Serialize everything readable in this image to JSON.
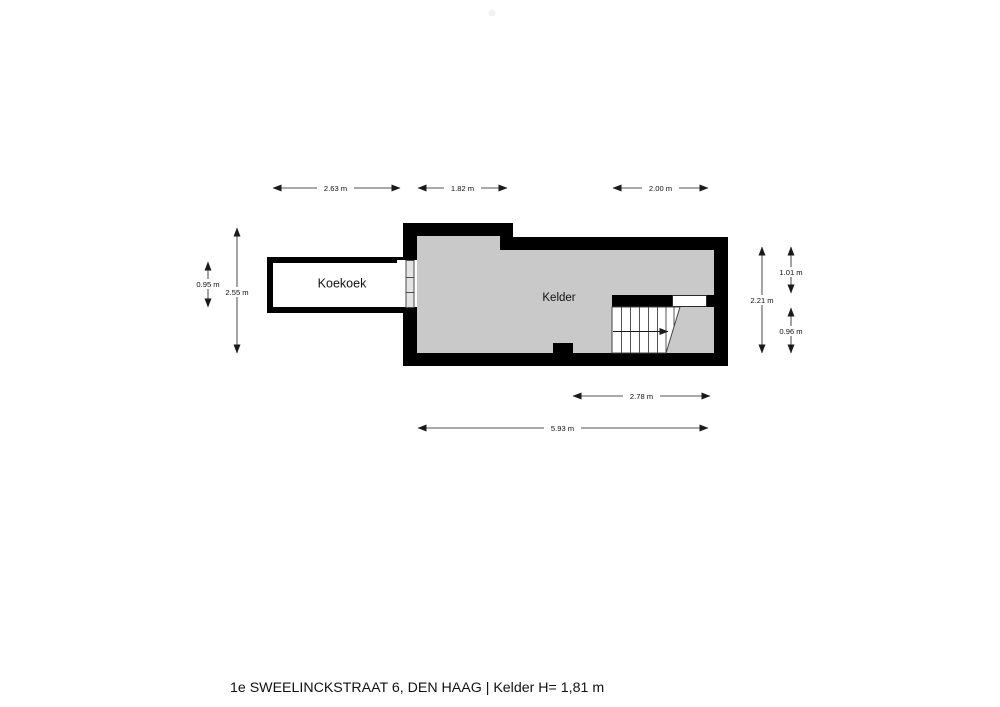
{
  "title": "1e SWEELINCKSTRAAT 6, DEN HAAG  | Kelder H= 1,81 m",
  "rooms": [
    {
      "name": "Koekoek"
    },
    {
      "name": "Kelder"
    }
  ],
  "dimensions": {
    "top": [
      {
        "label": "2.63 m"
      },
      {
        "label": "1.82 m"
      },
      {
        "label": "2.00 m"
      }
    ],
    "bottom": [
      {
        "label": "2.78 m"
      },
      {
        "label": "5.93 m"
      }
    ],
    "left": [
      {
        "label": "0.95 m"
      },
      {
        "label": "2.55 m"
      }
    ],
    "right": [
      {
        "label": "1.01 m"
      },
      {
        "label": "2.21 m"
      },
      {
        "label": "0.96 m"
      }
    ]
  },
  "colors": {
    "wall": "#000000",
    "floor": "#c9c9c9",
    "room_fill": "#ffffff",
    "opening_fill": "#ffffff",
    "frame_fill": "#e4e4e4",
    "dim_line": "#1a1a1a",
    "text": "#111111",
    "background": "#ffffff"
  }
}
